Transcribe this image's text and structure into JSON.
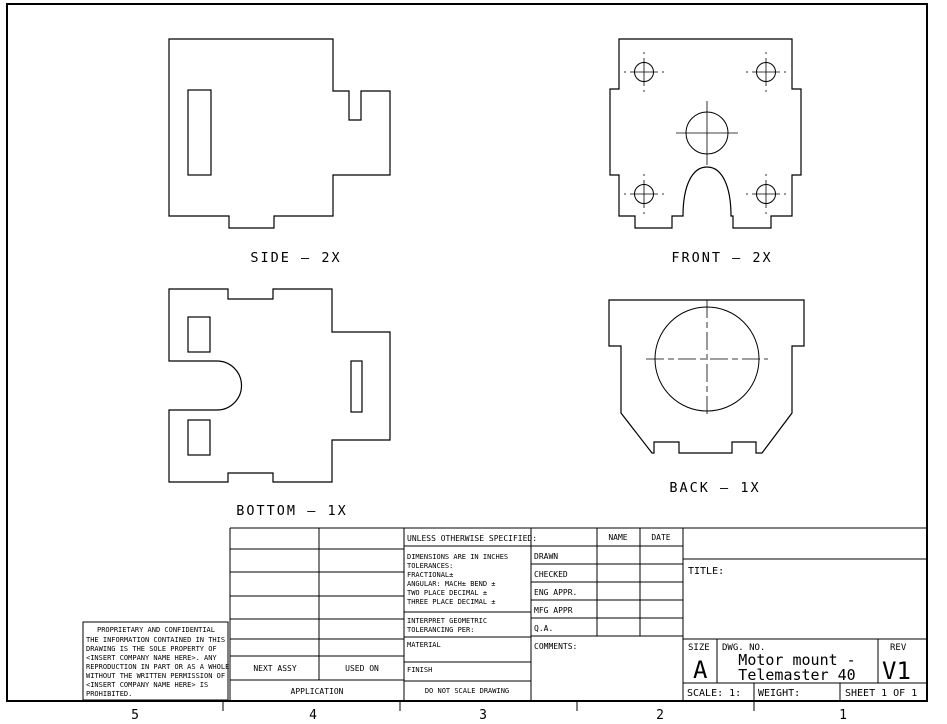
{
  "colors": {
    "ink": "#000000",
    "paper": "#ffffff"
  },
  "drawing": {
    "views": {
      "side": {
        "label": "SIDE – 2X"
      },
      "front": {
        "label": "FRONT – 2X"
      },
      "bottom": {
        "label": "BOTTOM – 1X"
      },
      "back": {
        "label": "BACK – 1X"
      }
    },
    "zones": [
      "5",
      "4",
      "3",
      "2",
      "1"
    ]
  },
  "tolerance_block": {
    "header": "UNLESS OTHERWISE SPECIFIED:",
    "lines": [
      "DIMENSIONS ARE IN INCHES",
      "TOLERANCES:",
      "FRACTIONAL±",
      "ANGULAR: MACH±  BEND ±",
      "TWO PLACE DECIMAL   ±",
      "THREE PLACE DECIMAL ±"
    ],
    "interpret_line1": "INTERPRET GEOMETRIC",
    "interpret_line2": "TOLERANCING PER:",
    "material": "MATERIAL",
    "finish": "FINISH",
    "do_not_scale": "DO NOT SCALE DRAWING"
  },
  "approval_table": {
    "name_header": "NAME",
    "date_header": "DATE",
    "rows": [
      "DRAWN",
      "CHECKED",
      "ENG APPR.",
      "MFG APPR",
      "Q.A."
    ],
    "comments": "COMMENTS:"
  },
  "application_block": {
    "next_assy": "NEXT ASSY",
    "used_on": "USED ON",
    "label": "APPLICATION"
  },
  "title_block": {
    "title_label": "TITLE:",
    "size_label": "SIZE",
    "size_value": "A",
    "dwg_label": "DWG.  NO.",
    "dwg_line1": "Motor mount -",
    "dwg_line2": "Telemaster 40",
    "rev_label": "REV",
    "rev_value": "V1",
    "scale": "SCALE: 1:",
    "weight": "WEIGHT:",
    "sheet": "SHEET 1 OF 1"
  },
  "proprietary": {
    "title": "PROPRIETARY AND CONFIDENTIAL",
    "lines": [
      "THE INFORMATION CONTAINED IN THIS",
      "DRAWING IS THE SOLE PROPERTY OF",
      "<INSERT COMPANY NAME HERE>. ANY",
      "REPRODUCTION IN PART OR AS A WHOLE",
      "WITHOUT THE WRITTEN PERMISSION OF",
      "<INSERT COMPANY NAME HERE> IS",
      "PROHIBITED."
    ]
  }
}
